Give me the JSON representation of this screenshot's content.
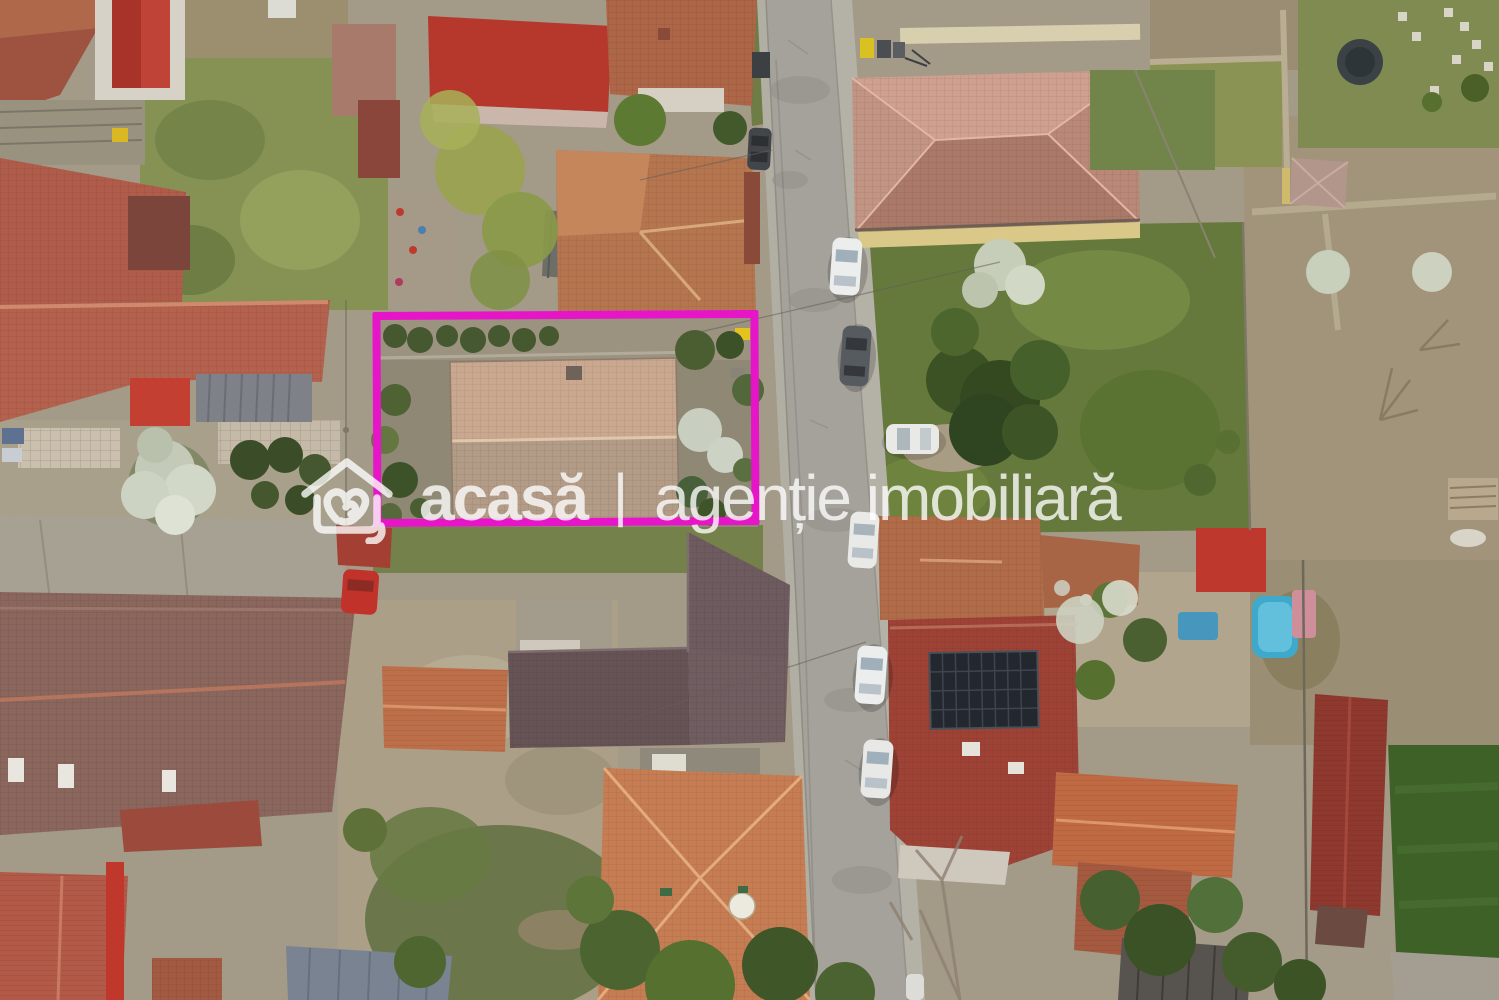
{
  "watermark": {
    "logo_icon": "house-heart-icon",
    "brand": "acasă",
    "divider": "|",
    "tagline": "agenție imobiliară"
  },
  "property_highlight": {
    "shape": "rectangle",
    "label": "highlighted land plot with tan-roof house"
  },
  "scene": {
    "type": "aerial-drone-photo",
    "description": "top-down view of residential street with tiled-roof houses, gardens, lawns and cars parked along a vertical gray road"
  },
  "colors": {
    "highlight": "#e616c8",
    "watermark": "#ffffff"
  }
}
